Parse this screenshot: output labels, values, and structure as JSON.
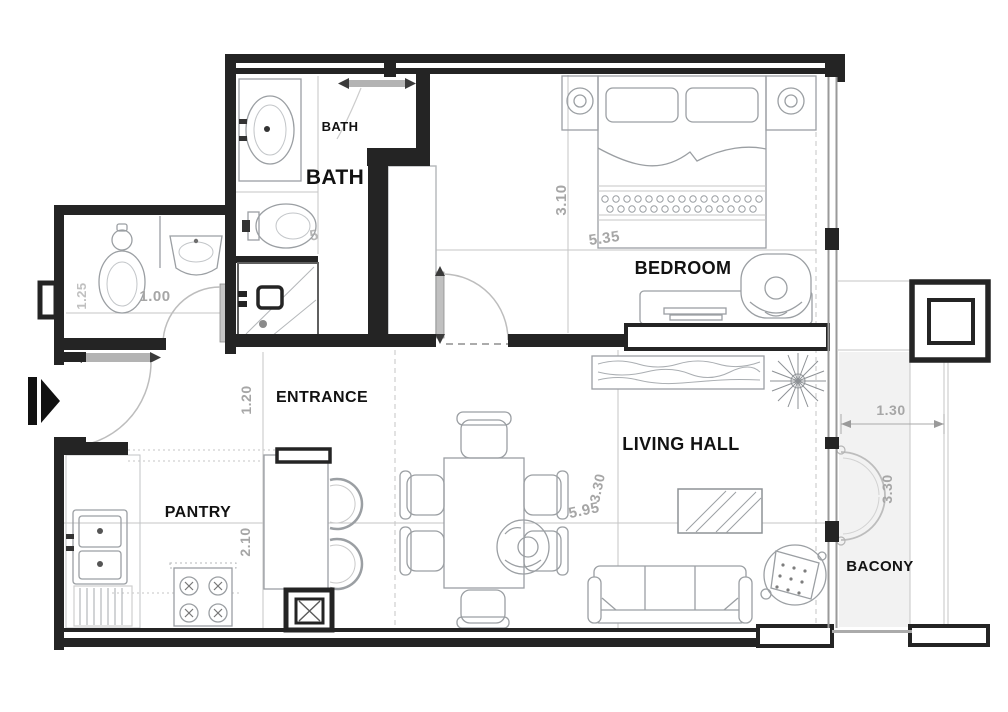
{
  "plan": {
    "labels": {
      "bath_upper": "BATH",
      "bath_main": "BATH",
      "bedroom": "BEDROOM",
      "entrance": "ENTRANCE",
      "living_hall": "LIVING HALL",
      "pantry": "PANTRY",
      "balcony": "BACONY"
    },
    "dimensions": {
      "bedroom_depth": "3.10",
      "bedroom_width": "5.35",
      "powder_width": "1.00",
      "powder_depth": "1.25",
      "bath_fixture": "5",
      "entrance_width": "1.20",
      "pantry_depth": "2.10",
      "living_width": "5.95",
      "living_depth": "3.30",
      "balcony_width": "1.30",
      "balcony_depth": "3.30"
    },
    "colors": {
      "wall": "#242424",
      "furniture_line": "#9b9fa3",
      "dimension_text": "#a6a6a6",
      "label_text": "#121212"
    }
  }
}
